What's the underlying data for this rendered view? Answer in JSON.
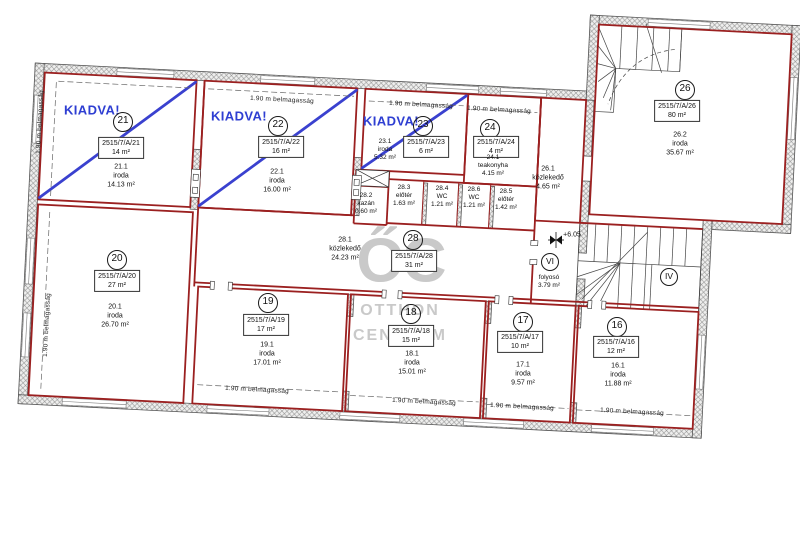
{
  "watermark": {
    "monogram": "ŐC",
    "line1": "OTTHON",
    "line2": "CENTRUM"
  },
  "labels": {
    "height": "1.90 m belmagasság",
    "kiadva": "KIADVA!",
    "level": "+6.05"
  },
  "corridors": {
    "vi": {
      "number": "VI",
      "name": "folyosó",
      "area": "3.79 m²"
    },
    "iv": {
      "number": "IV"
    }
  },
  "units": {
    "u21": {
      "number": "21",
      "lot": "2515/7/A/21",
      "nominal": "14 m²",
      "rooms": [
        {
          "no": "21.1",
          "type": "iroda",
          "area": "14.13 m²"
        }
      ]
    },
    "u22": {
      "number": "22",
      "lot": "2515/7/A/22",
      "nominal": "16 m²",
      "rooms": [
        {
          "no": "22.1",
          "type": "iroda",
          "area": "16.00 m²"
        }
      ]
    },
    "u23": {
      "number": "23",
      "lot": "2515/7/A/23",
      "nominal": "6 m²",
      "rooms": [
        {
          "no": "23.1",
          "type": "iroda",
          "area": "5.32 m²"
        }
      ]
    },
    "u24": {
      "number": "24",
      "lot": "2515/7/A/24",
      "nominal": "4 m²",
      "rooms": [
        {
          "no": "24.1",
          "type": "teakonyha",
          "area": "4.15 m²"
        }
      ]
    },
    "u26": {
      "number": "26",
      "lot": "2515/7/A/26",
      "nominal": "80 m²",
      "rooms": [
        {
          "no": "26.1",
          "type": "közlekedő",
          "area": "4.65 m²"
        },
        {
          "no": "26.2",
          "type": "iroda",
          "area": "35.67 m²"
        }
      ]
    },
    "u28": {
      "number": "28",
      "lot": "2515/7/A/28",
      "nominal": "31 m²",
      "rooms": [
        {
          "no": "28.1",
          "type": "közlekedő",
          "area": "24.23 m²"
        },
        {
          "no": "28.2",
          "type": "kazán",
          "area": "0.60 m²"
        },
        {
          "no": "28.3",
          "type": "előtér",
          "area": "1.63 m²"
        },
        {
          "no": "28.4",
          "type": "WC",
          "area": "1.21 m²"
        },
        {
          "no": "28.6",
          "type": "WC",
          "area": "1.21 m²"
        },
        {
          "no": "28.5",
          "type": "előtér",
          "area": "1.42 m²"
        }
      ]
    },
    "u20": {
      "number": "20",
      "lot": "2515/7/A/20",
      "nominal": "27 m²",
      "rooms": [
        {
          "no": "20.1",
          "type": "iroda",
          "area": "26.70 m²"
        }
      ]
    },
    "u19": {
      "number": "19",
      "lot": "2515/7/A/19",
      "nominal": "17 m²",
      "rooms": [
        {
          "no": "19.1",
          "type": "iroda",
          "area": "17.01 m²"
        }
      ]
    },
    "u18": {
      "number": "18",
      "lot": "2515/7/A/18",
      "nominal": "15 m²",
      "rooms": [
        {
          "no": "18.1",
          "type": "iroda",
          "area": "15.01 m²"
        }
      ]
    },
    "u17": {
      "number": "17",
      "lot": "2515/7/A/17",
      "nominal": "10 m²",
      "rooms": [
        {
          "no": "17.1",
          "type": "iroda",
          "area": "9.57 m²"
        }
      ]
    },
    "u16": {
      "number": "16",
      "lot": "2515/7/A/16",
      "nominal": "12 m²",
      "rooms": [
        {
          "no": "16.1",
          "type": "iroda",
          "area": "11.88 m²"
        }
      ]
    }
  },
  "colors": {
    "unit_outline": "#9b2020",
    "kiadva_blue": "#3a41cf",
    "watermark": "#c9c9c9"
  }
}
